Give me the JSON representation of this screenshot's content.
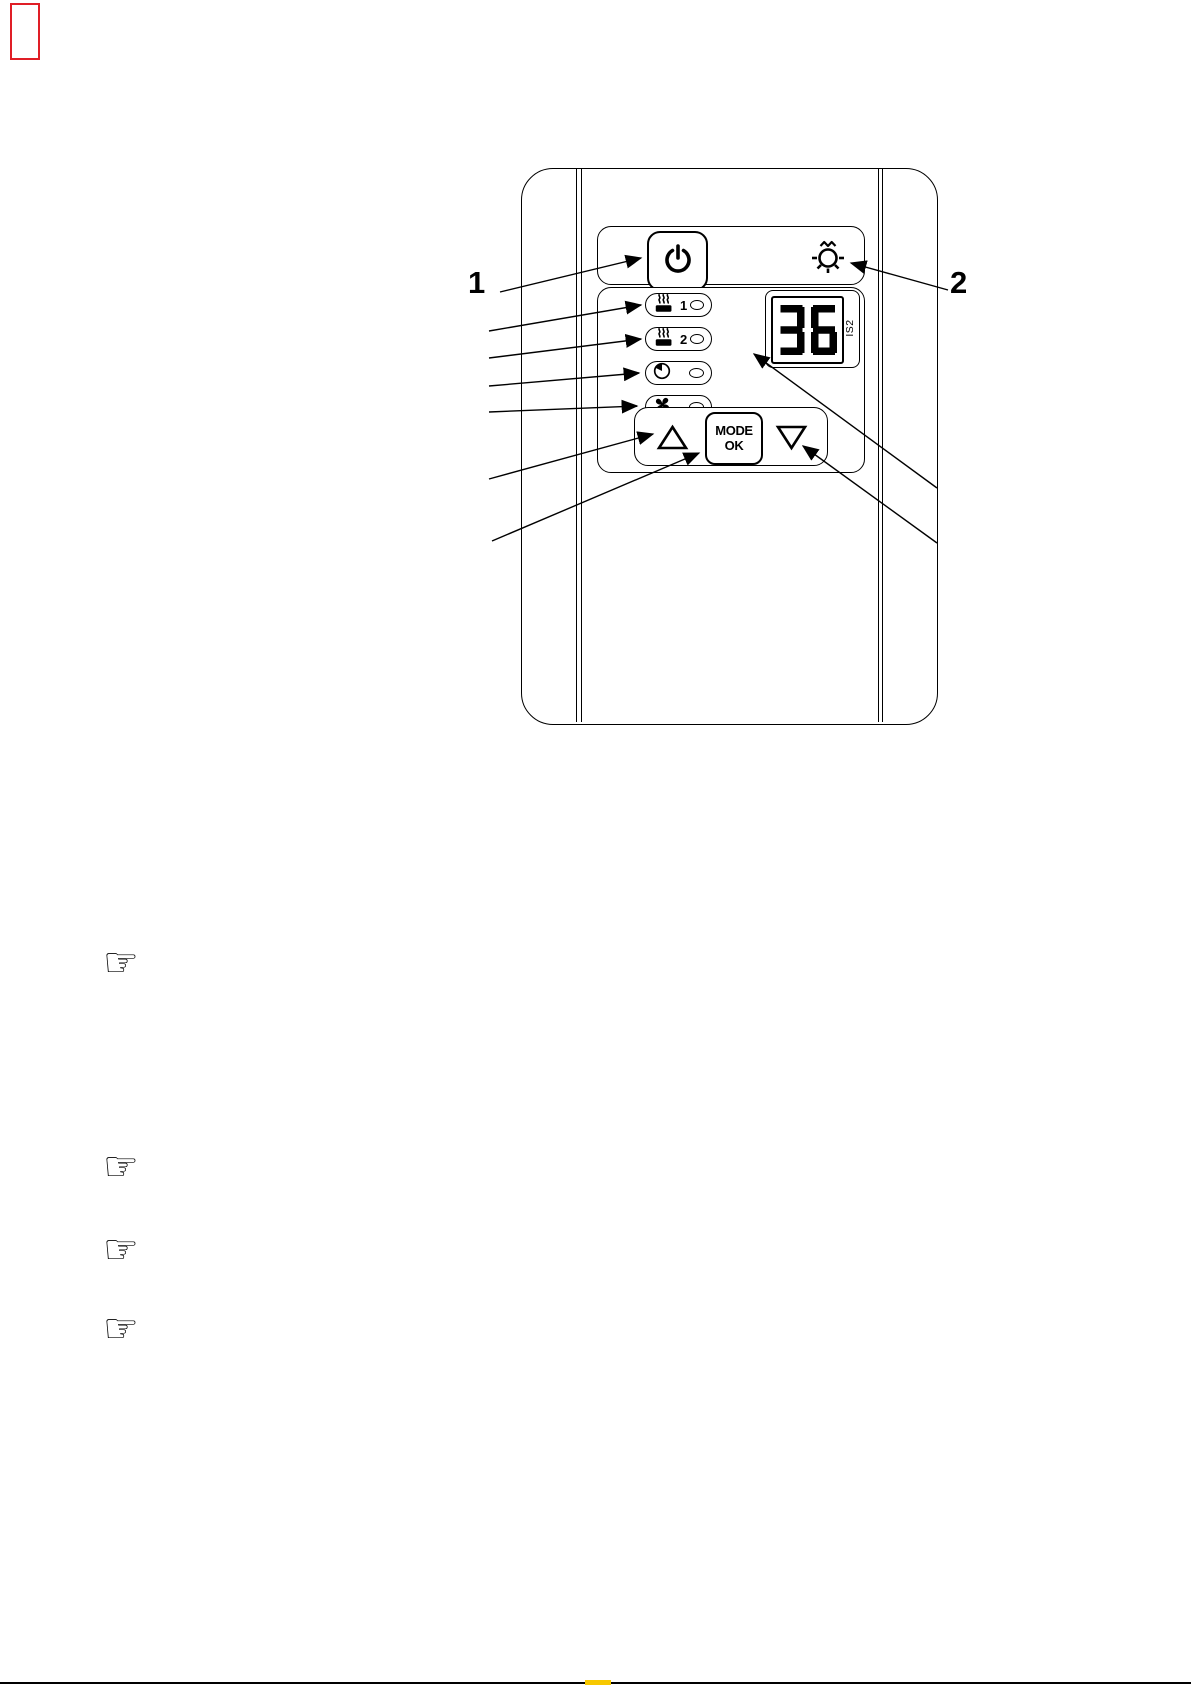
{
  "page": {
    "background": "#ffffff"
  },
  "pdf_artifacts": {
    "link_box_color": "#e01e26",
    "bottom_rule_color": "#000000",
    "bottom_highlight_color": "#f7c800"
  },
  "callouts": {
    "power_ref": "1",
    "light_ref": "2"
  },
  "panel": {
    "display": {
      "value": "36",
      "side_label": "IS2"
    },
    "indicators": [
      {
        "name": "heater-stage-1",
        "label": "1"
      },
      {
        "name": "heater-stage-2",
        "label": "2"
      },
      {
        "name": "timer",
        "label": ""
      },
      {
        "name": "fan",
        "label": ""
      }
    ],
    "mode_button": {
      "line1": "MODE",
      "line2": "OK"
    }
  },
  "notes": {
    "manicule_glyph": "☞"
  }
}
